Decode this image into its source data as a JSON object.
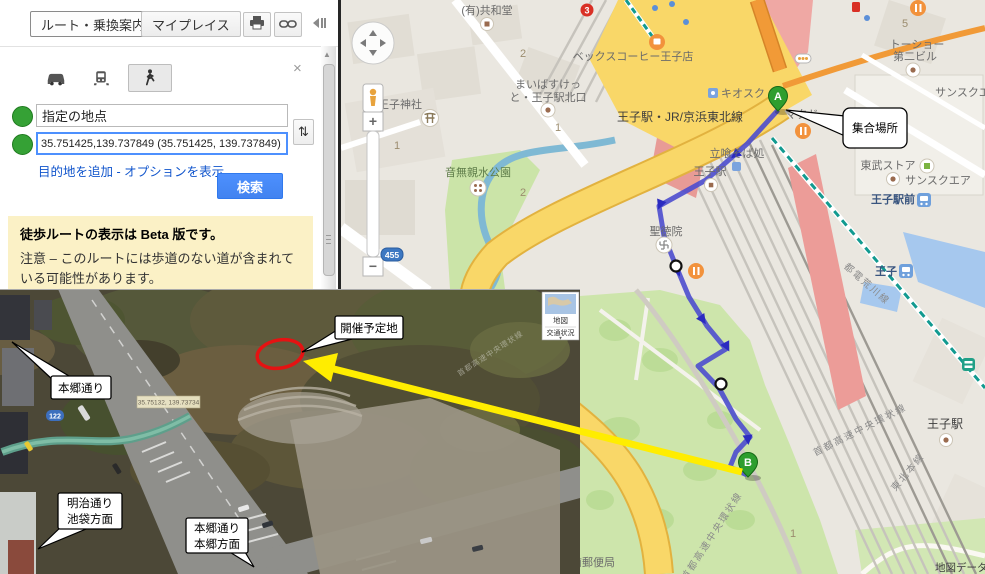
{
  "panel": {
    "route_button": "ルート・乗換案内",
    "myplaces_button": "マイプレイス",
    "close_glyph": "×",
    "origin_value": "指定の地点",
    "destination_value": "35.751425,139.737849 (35.751425, 139.737849)",
    "swap_glyph": "⇅",
    "add_destination_link": "目的地を追加",
    "link_separator": " - ",
    "show_options_link": "オプションを表示",
    "search_button": "検索",
    "warning_title": "徒歩ルートの表示は Beta 版です。",
    "warning_body": "注意 – このルートには歩道のない道が含まれている可能性があります。",
    "scroll_up_glyph": "▲"
  },
  "map": {
    "marker_a": "A",
    "marker_b": "B",
    "meeting_callout": "集合場所",
    "zoom_plus": "+",
    "zoom_minus": "−",
    "shield_455": "455",
    "attribution": "地図データ",
    "labels": {
      "kyowado": "(有)共和堂",
      "maibasket_1": "まいばすけっ",
      "maibasket_2": "と・王子駅北口",
      "becks": "ベックスコーヒー王子店",
      "oji_jinja": "王子神社",
      "otonashi_park": "音無親水公園",
      "oji_sta_jr": "王子駅・JR/京浜東北線",
      "kiosk": "キオスク",
      "tachigui_soba": "立喰そば処",
      "oji_sta_small": "王子駅",
      "mcdonalds": "マクド",
      "tobu_store": "東武ストア",
      "sunsquare": "サンスクエア",
      "tosho_1": "トーショー",
      "tosho_2": "第二ビル",
      "sunsquare_right": "サンスクエア",
      "shotokuin": "聖徳院",
      "oji_ekimae": "王子駅前",
      "oji_tram": "王子",
      "toden_arakawa": "都電荒川線",
      "tohoku_line": "東北本線",
      "shuto_expwy_1": "首都高速中央環状線",
      "shuto_expwy_2": "首都高速中央環状線",
      "oji_sta_south": "王子駅",
      "post_office": "鳥山前郵便局",
      "num_2a": "2",
      "num_1a": "1",
      "num_1b": "1",
      "num_2b": "2",
      "num_1c": "1",
      "num_5": "5",
      "num_3": "3"
    }
  },
  "aerial": {
    "venue_callout": "開催予定地",
    "hongo_callout": "本郷通り",
    "meiji_callout_1": "明治通り",
    "meiji_callout_2": "池袋方面",
    "hongo2_callout_1": "本郷通り",
    "hongo2_callout_2": "本郷方面",
    "coord_tag": "35.75132, 139.73734",
    "maptype_map": "地図",
    "maptype_traffic": "交通状況",
    "traffic_caret": "▼",
    "faint_expwy": "首都高速中央環状線",
    "shield_122": "122"
  },
  "colors": {
    "accent_blue": "#4285F4",
    "route_purple": "#4C4CCE",
    "marker_green": "#2E9E2E",
    "warning_bg": "#FBF1C6",
    "arrow_yellow": "#FFED00",
    "circle_red": "#E51212"
  }
}
